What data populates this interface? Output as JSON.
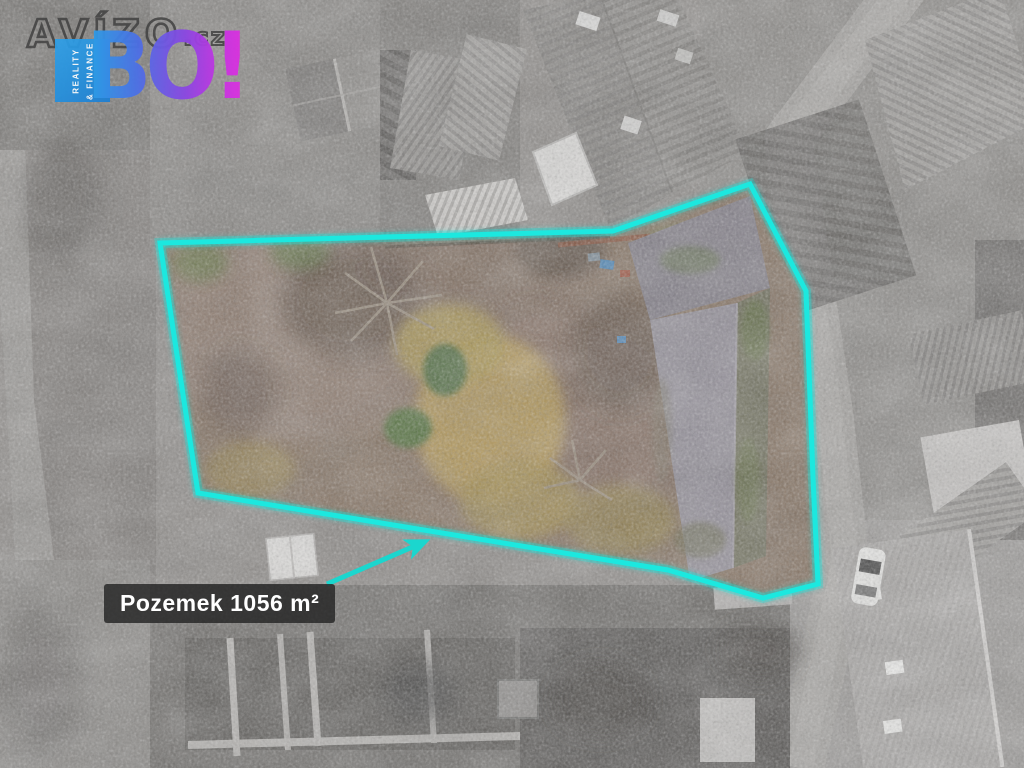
{
  "watermark": {
    "brand": "AVÍZO",
    "brand_suffix": ".cz",
    "badge_line1": "REALITY",
    "badge_line2": "& FINANCE",
    "brand_short": "BO!",
    "colors": {
      "badge_blue": "#2d9ce6",
      "gradient_start": "#2d9ce6",
      "gradient_mid": "#8a46e2",
      "gradient_end": "#e02ede",
      "outline_gray": "#3a3a3a"
    }
  },
  "annotation": {
    "parcel_label": "Pozemek 1056 m²",
    "accent_color": "#19e7de",
    "outline_points": "160,243 613,231 750,184 806,291 813,478 818,584 763,598 668,570 198,493",
    "arrow_points": "327,584 424,542"
  }
}
